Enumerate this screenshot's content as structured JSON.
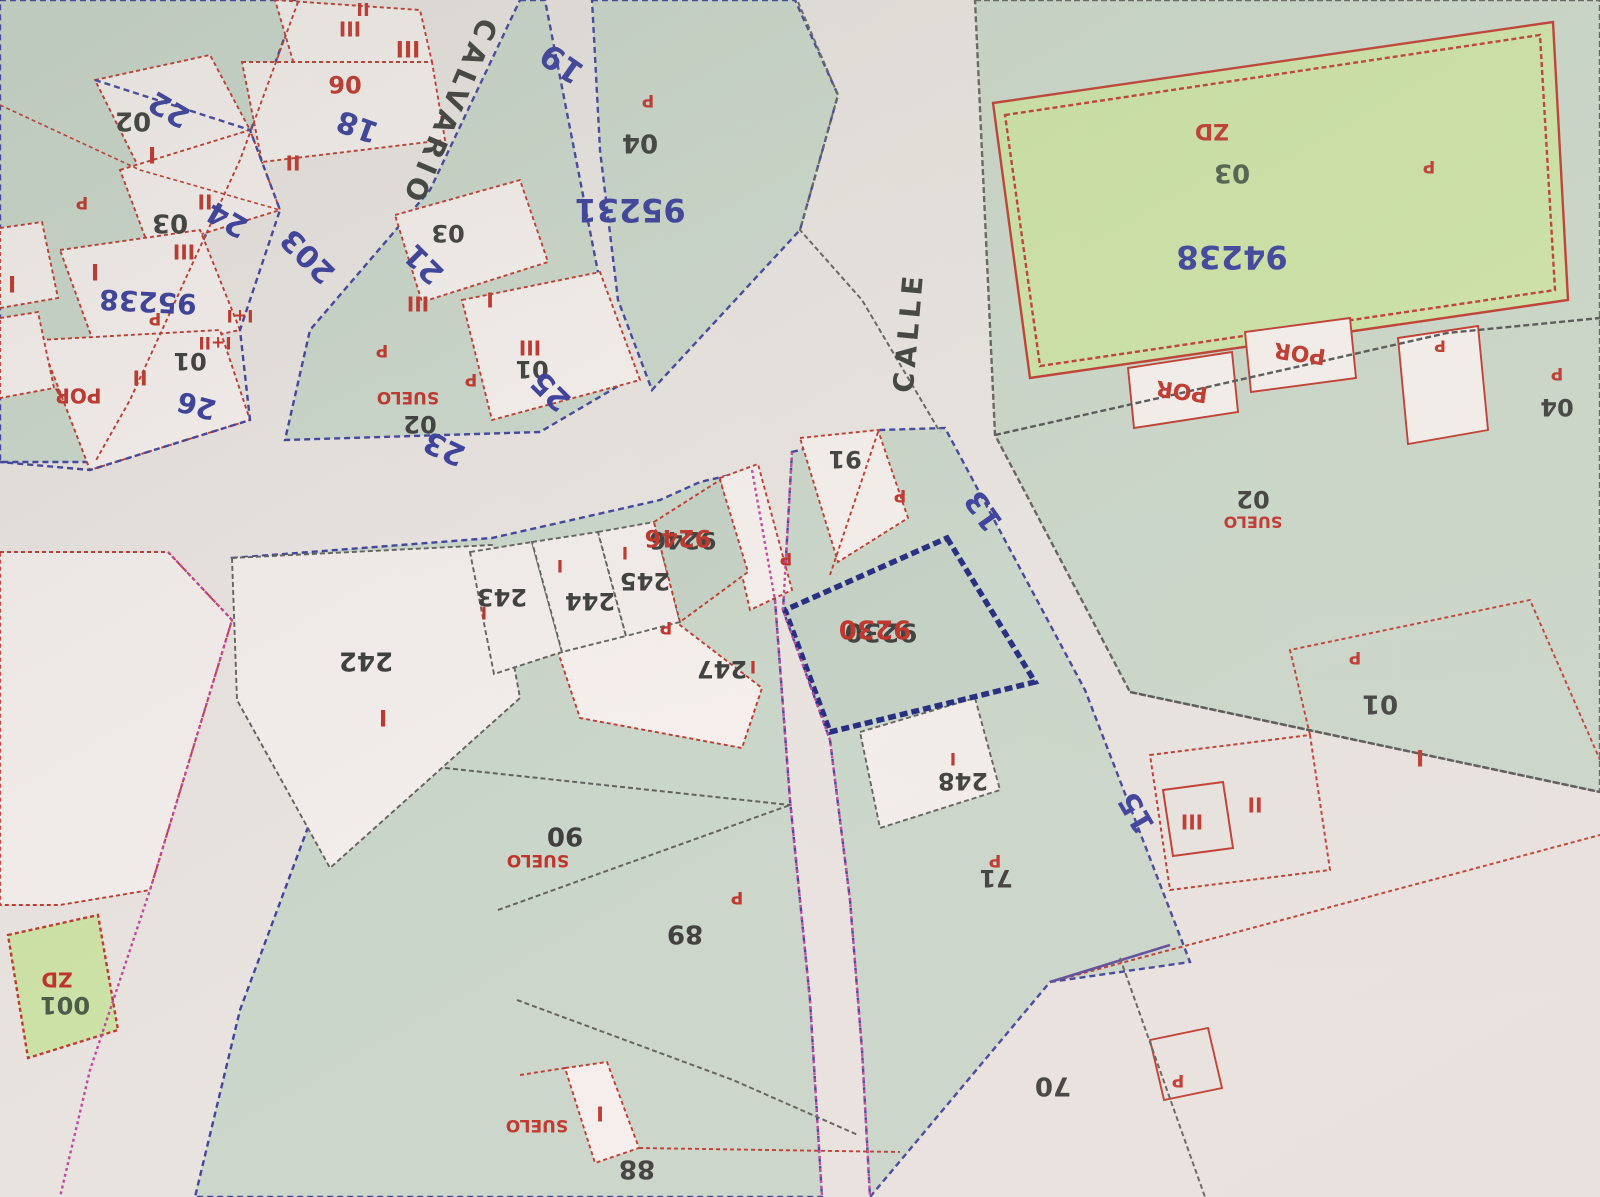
{
  "map": {
    "kind": "cadastral plan photo (upside down)",
    "streets": [
      "CALVARIO",
      "CALLE"
    ],
    "highlighted_parcel": "9230",
    "colors": {
      "paper": "#e9e3e0",
      "parcel_green": "#cbd6ca",
      "parcel_green_dark": "#c5d1c5",
      "bright_green": "#cde2a6",
      "parcel_white": "#f3edeb",
      "parcel_pink": "#f6efed",
      "line_blue": "#41439e",
      "line_red": "#c0392f",
      "line_magenta": "#c2499c",
      "line_gray": "#62625e",
      "line_navy_thick": "#232a80",
      "text_blue": "#3b3e9c",
      "text_black": "#3f3f3d",
      "text_red": "#c0342c",
      "text_darkgreen": "#4c5c4a"
    },
    "labels": [
      {
        "t": "02",
        "x": 133,
        "y": 120,
        "r": 180,
        "c": "k",
        "s": 26
      },
      {
        "t": "I",
        "x": 152,
        "y": 153,
        "r": 180,
        "c": "r",
        "s": 22
      },
      {
        "t": "22",
        "x": 170,
        "y": 108,
        "r": 210,
        "c": "b",
        "s": 30
      },
      {
        "t": "03",
        "x": 170,
        "y": 222,
        "r": 180,
        "c": "k",
        "s": 26
      },
      {
        "t": "II",
        "x": 205,
        "y": 200,
        "r": 180,
        "c": "r",
        "s": 20
      },
      {
        "t": "III",
        "x": 184,
        "y": 250,
        "r": 180,
        "c": "r",
        "s": 20
      },
      {
        "t": "I",
        "x": 95,
        "y": 270,
        "r": 180,
        "c": "r",
        "s": 22
      },
      {
        "t": "I",
        "x": 12,
        "y": 282,
        "r": 180,
        "c": "r",
        "s": 22
      },
      {
        "t": "95238",
        "x": 148,
        "y": 300,
        "r": 183,
        "c": "b",
        "s": 28
      },
      {
        "t": "P",
        "x": 155,
        "y": 318,
        "r": 180,
        "c": "r",
        "s": 17
      },
      {
        "t": "P",
        "x": 82,
        "y": 202,
        "r": 180,
        "c": "r",
        "s": 17
      },
      {
        "t": "01",
        "x": 190,
        "y": 360,
        "r": 180,
        "c": "k",
        "s": 24
      },
      {
        "t": "I+I",
        "x": 240,
        "y": 315,
        "r": 180,
        "c": "r",
        "s": 17
      },
      {
        "t": "I+II",
        "x": 215,
        "y": 342,
        "r": 180,
        "c": "r",
        "s": 17
      },
      {
        "t": "II",
        "x": 140,
        "y": 376,
        "r": 180,
        "c": "r",
        "s": 20
      },
      {
        "t": "POR",
        "x": 78,
        "y": 394,
        "r": 180,
        "c": "r",
        "s": 20
      },
      {
        "t": "26",
        "x": 197,
        "y": 404,
        "r": 195,
        "c": "b",
        "s": 28
      },
      {
        "t": "II",
        "x": 293,
        "y": 161,
        "r": 180,
        "c": "r",
        "s": 20
      },
      {
        "t": "24",
        "x": 228,
        "y": 218,
        "r": 210,
        "c": "b",
        "s": 30
      },
      {
        "t": "II",
        "x": 363,
        "y": 8,
        "r": 180,
        "c": "r",
        "s": 18
      },
      {
        "t": "III",
        "x": 350,
        "y": 27,
        "r": 180,
        "c": "r",
        "s": 20
      },
      {
        "t": "III",
        "x": 408,
        "y": 47,
        "r": 180,
        "c": "r",
        "s": 22
      },
      {
        "t": "06",
        "x": 345,
        "y": 83,
        "r": 180,
        "c": "r",
        "s": 24
      },
      {
        "t": "18",
        "x": 358,
        "y": 125,
        "r": 200,
        "c": "b",
        "s": 30
      },
      {
        "t": "203",
        "x": 309,
        "y": 255,
        "r": 225,
        "c": "b",
        "s": 30
      },
      {
        "t": "CALVARIO",
        "x": 448,
        "y": 112,
        "r": 113,
        "c": "k",
        "s": 28,
        "ls": 6
      },
      {
        "t": "19",
        "x": 563,
        "y": 62,
        "r": 215,
        "c": "b",
        "s": 32
      },
      {
        "t": "03",
        "x": 448,
        "y": 232,
        "r": 180,
        "c": "k",
        "s": 24
      },
      {
        "t": "21",
        "x": 425,
        "y": 263,
        "r": 225,
        "c": "b",
        "s": 30
      },
      {
        "t": "III",
        "x": 418,
        "y": 302,
        "r": 180,
        "c": "r",
        "s": 20
      },
      {
        "t": "I",
        "x": 490,
        "y": 298,
        "r": 180,
        "c": "r",
        "s": 20
      },
      {
        "t": "III",
        "x": 530,
        "y": 346,
        "r": 180,
        "c": "r",
        "s": 20
      },
      {
        "t": "01",
        "x": 532,
        "y": 368,
        "r": 180,
        "c": "k",
        "s": 24
      },
      {
        "t": "25",
        "x": 552,
        "y": 390,
        "r": 225,
        "c": "b",
        "s": 30
      },
      {
        "t": "P",
        "x": 382,
        "y": 350,
        "r": 180,
        "c": "r",
        "s": 17
      },
      {
        "t": "P",
        "x": 471,
        "y": 379,
        "r": 180,
        "c": "r",
        "s": 17
      },
      {
        "t": "SUELO",
        "x": 408,
        "y": 397,
        "r": 180,
        "c": "r",
        "s": 17
      },
      {
        "t": "02",
        "x": 420,
        "y": 423,
        "r": 180,
        "c": "k",
        "s": 24
      },
      {
        "t": "23",
        "x": 445,
        "y": 447,
        "r": 205,
        "c": "b",
        "s": 30
      },
      {
        "t": "P",
        "x": 648,
        "y": 100,
        "r": 180,
        "c": "r",
        "s": 17
      },
      {
        "t": "04",
        "x": 640,
        "y": 142,
        "r": 180,
        "c": "k",
        "s": 26
      },
      {
        "t": "95231",
        "x": 630,
        "y": 208,
        "r": 180,
        "c": "b",
        "s": 32
      },
      {
        "t": "CALLE",
        "x": 910,
        "y": 332,
        "r": 275,
        "c": "k",
        "s": 28,
        "ls": 5
      },
      {
        "t": "13",
        "x": 985,
        "y": 510,
        "r": 235,
        "c": "b",
        "s": 30
      },
      {
        "t": "ZD",
        "x": 1212,
        "y": 130,
        "r": 180,
        "c": "r",
        "s": 22
      },
      {
        "t": "03",
        "x": 1232,
        "y": 172,
        "r": 180,
        "c": "g",
        "s": 26
      },
      {
        "t": "94238",
        "x": 1232,
        "y": 255,
        "r": 180,
        "c": "b",
        "s": 32
      },
      {
        "t": "POR",
        "x": 1182,
        "y": 390,
        "r": 188,
        "c": "r",
        "s": 22
      },
      {
        "t": "POR",
        "x": 1300,
        "y": 352,
        "r": 188,
        "c": "r",
        "s": 22
      },
      {
        "t": "P",
        "x": 1440,
        "y": 345,
        "r": 180,
        "c": "r",
        "s": 16
      },
      {
        "t": "P",
        "x": 1429,
        "y": 166,
        "r": 180,
        "c": "r",
        "s": 17
      },
      {
        "t": "04",
        "x": 1557,
        "y": 406,
        "r": 180,
        "c": "k",
        "s": 24
      },
      {
        "t": "P",
        "x": 1557,
        "y": 373,
        "r": 180,
        "c": "r",
        "s": 17
      },
      {
        "t": "02",
        "x": 1253,
        "y": 498,
        "r": 180,
        "c": "k",
        "s": 24
      },
      {
        "t": "SUELO",
        "x": 1253,
        "y": 521,
        "r": 180,
        "c": "r",
        "s": 16
      },
      {
        "t": "242",
        "x": 366,
        "y": 660,
        "r": 180,
        "c": "k",
        "s": 26
      },
      {
        "t": "I",
        "x": 383,
        "y": 716,
        "r": 180,
        "c": "r",
        "s": 22
      },
      {
        "t": "243",
        "x": 502,
        "y": 596,
        "r": 180,
        "c": "k",
        "s": 24
      },
      {
        "t": "I",
        "x": 484,
        "y": 612,
        "r": 180,
        "c": "r",
        "s": 17
      },
      {
        "t": "244",
        "x": 590,
        "y": 600,
        "r": 180,
        "c": "k",
        "s": 24
      },
      {
        "t": "245",
        "x": 645,
        "y": 580,
        "r": 180,
        "c": "k",
        "s": 24
      },
      {
        "t": "I",
        "x": 560,
        "y": 565,
        "r": 180,
        "c": "r",
        "s": 17
      },
      {
        "t": "I",
        "x": 625,
        "y": 552,
        "r": 180,
        "c": "r",
        "s": 17
      },
      {
        "t": "9246",
        "x": 683,
        "y": 539,
        "r": 180,
        "c": "k",
        "s": 24
      },
      {
        "t": "9246",
        "x": 678,
        "y": 537,
        "r": 180,
        "c": "r",
        "s": 24
      },
      {
        "t": "91",
        "x": 845,
        "y": 458,
        "r": 180,
        "c": "k",
        "s": 24
      },
      {
        "t": "P",
        "x": 900,
        "y": 495,
        "r": 180,
        "c": "r",
        "s": 17
      },
      {
        "t": "P",
        "x": 786,
        "y": 558,
        "r": 180,
        "c": "r",
        "s": 17
      },
      {
        "t": "P",
        "x": 666,
        "y": 627,
        "r": 180,
        "c": "r",
        "s": 17
      },
      {
        "t": "247",
        "x": 722,
        "y": 668,
        "r": 180,
        "c": "k",
        "s": 24
      },
      {
        "t": "I",
        "x": 753,
        "y": 666,
        "r": 180,
        "c": "r",
        "s": 17
      },
      {
        "t": "9230",
        "x": 881,
        "y": 631,
        "r": 180,
        "c": "k",
        "s": 26
      },
      {
        "t": "9230",
        "x": 875,
        "y": 628,
        "r": 180,
        "c": "r",
        "s": 26
      },
      {
        "t": "248",
        "x": 963,
        "y": 780,
        "r": 180,
        "c": "k",
        "s": 24
      },
      {
        "t": "I",
        "x": 953,
        "y": 758,
        "r": 180,
        "c": "r",
        "s": 17
      },
      {
        "t": "P",
        "x": 995,
        "y": 860,
        "r": 180,
        "c": "r",
        "s": 17
      },
      {
        "t": "71",
        "x": 996,
        "y": 877,
        "r": 180,
        "c": "k",
        "s": 24
      },
      {
        "t": "90",
        "x": 565,
        "y": 835,
        "r": 180,
        "c": "k",
        "s": 26
      },
      {
        "t": "SUELO",
        "x": 538,
        "y": 860,
        "r": 180,
        "c": "r",
        "s": 17
      },
      {
        "t": "P",
        "x": 737,
        "y": 897,
        "r": 180,
        "c": "r",
        "s": 17
      },
      {
        "t": "89",
        "x": 685,
        "y": 933,
        "r": 180,
        "c": "k",
        "s": 26
      },
      {
        "t": "SUELO",
        "x": 537,
        "y": 1125,
        "r": 180,
        "c": "r",
        "s": 17
      },
      {
        "t": "I",
        "x": 600,
        "y": 1112,
        "r": 180,
        "c": "r",
        "s": 20
      },
      {
        "t": "88",
        "x": 637,
        "y": 1168,
        "r": 180,
        "c": "k",
        "s": 26
      },
      {
        "t": "15",
        "x": 1138,
        "y": 812,
        "r": 240,
        "c": "b",
        "s": 30
      },
      {
        "t": "III",
        "x": 1192,
        "y": 820,
        "r": 180,
        "c": "r",
        "s": 20
      },
      {
        "t": "II",
        "x": 1255,
        "y": 803,
        "r": 180,
        "c": "r",
        "s": 20
      },
      {
        "t": "P",
        "x": 1355,
        "y": 657,
        "r": 180,
        "c": "r",
        "s": 17
      },
      {
        "t": "01",
        "x": 1380,
        "y": 703,
        "r": 180,
        "c": "k",
        "s": 26
      },
      {
        "t": "I",
        "x": 1420,
        "y": 756,
        "r": 180,
        "c": "r",
        "s": 22
      },
      {
        "t": "70",
        "x": 1053,
        "y": 1085,
        "r": 180,
        "c": "k",
        "s": 26
      },
      {
        "t": "P",
        "x": 1178,
        "y": 1080,
        "r": 180,
        "c": "r",
        "s": 17
      },
      {
        "t": "ZD",
        "x": 57,
        "y": 978,
        "r": 180,
        "c": "r",
        "s": 20
      },
      {
        "t": "001",
        "x": 65,
        "y": 1004,
        "r": 180,
        "c": "g",
        "s": 24
      }
    ]
  }
}
